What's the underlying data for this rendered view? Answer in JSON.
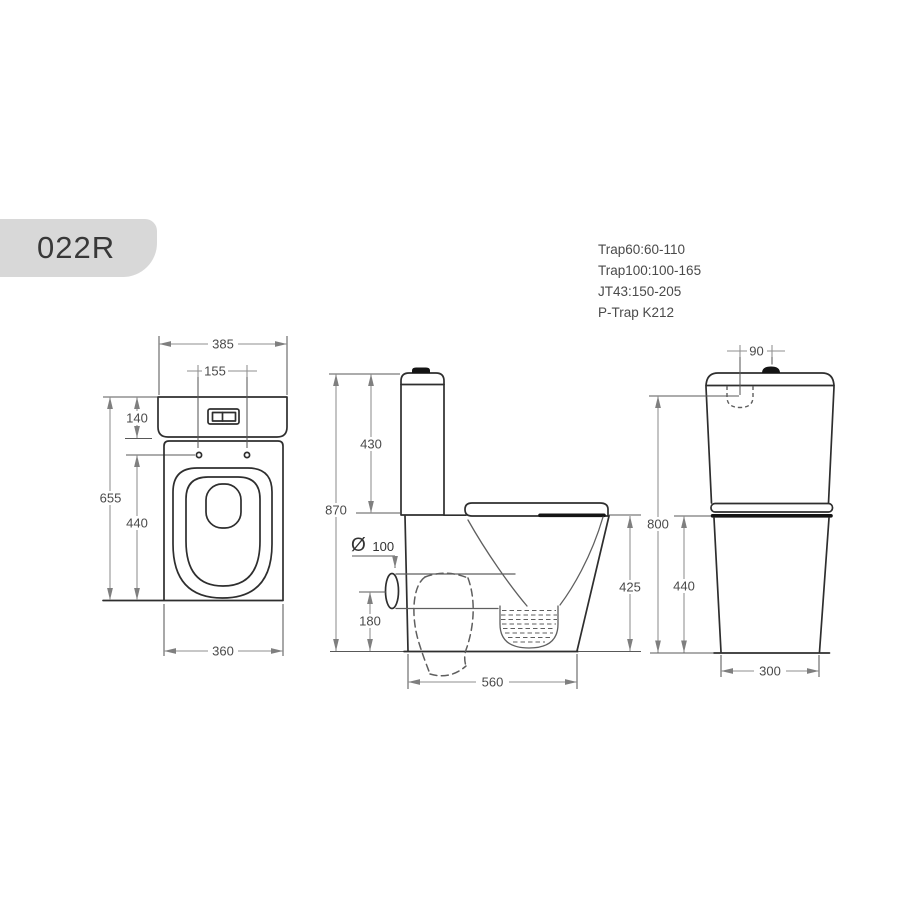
{
  "model_badge": {
    "label": "022R"
  },
  "trap_notes": {
    "lines": [
      "Trap60:60-110",
      "Trap100:100-165",
      "JT43:150-205",
      "P-Trap K212"
    ]
  },
  "views": {
    "front": {
      "dims": {
        "cistern_width": "385",
        "button_hole_spacing": "155",
        "cistern_height": "140",
        "overall_height": "655",
        "pan_height": "440",
        "base_width": "360"
      }
    },
    "side": {
      "dims": {
        "overall_height": "870",
        "cistern_height": "430",
        "outlet_symbol": "Ø",
        "outlet_diameter": "100",
        "outlet_center_height": "180",
        "overall_depth": "560",
        "rim_height": "425"
      }
    },
    "back": {
      "dims": {
        "inlet_offset": "90",
        "inlet_height": "800",
        "pan_height": "440",
        "base_width": "300"
      }
    }
  },
  "colors": {
    "paper": "#ffffff",
    "badge_fill": "#d8d8d8",
    "ink": "#2e2e2e",
    "ink_heavy": "#141414",
    "ink_light": "#5f5f5f",
    "dim_line": "#8f8f8f",
    "ext_line": "#585858",
    "dim_text": "#4a4a4a",
    "arrow_fill": "#7f7f7f"
  }
}
